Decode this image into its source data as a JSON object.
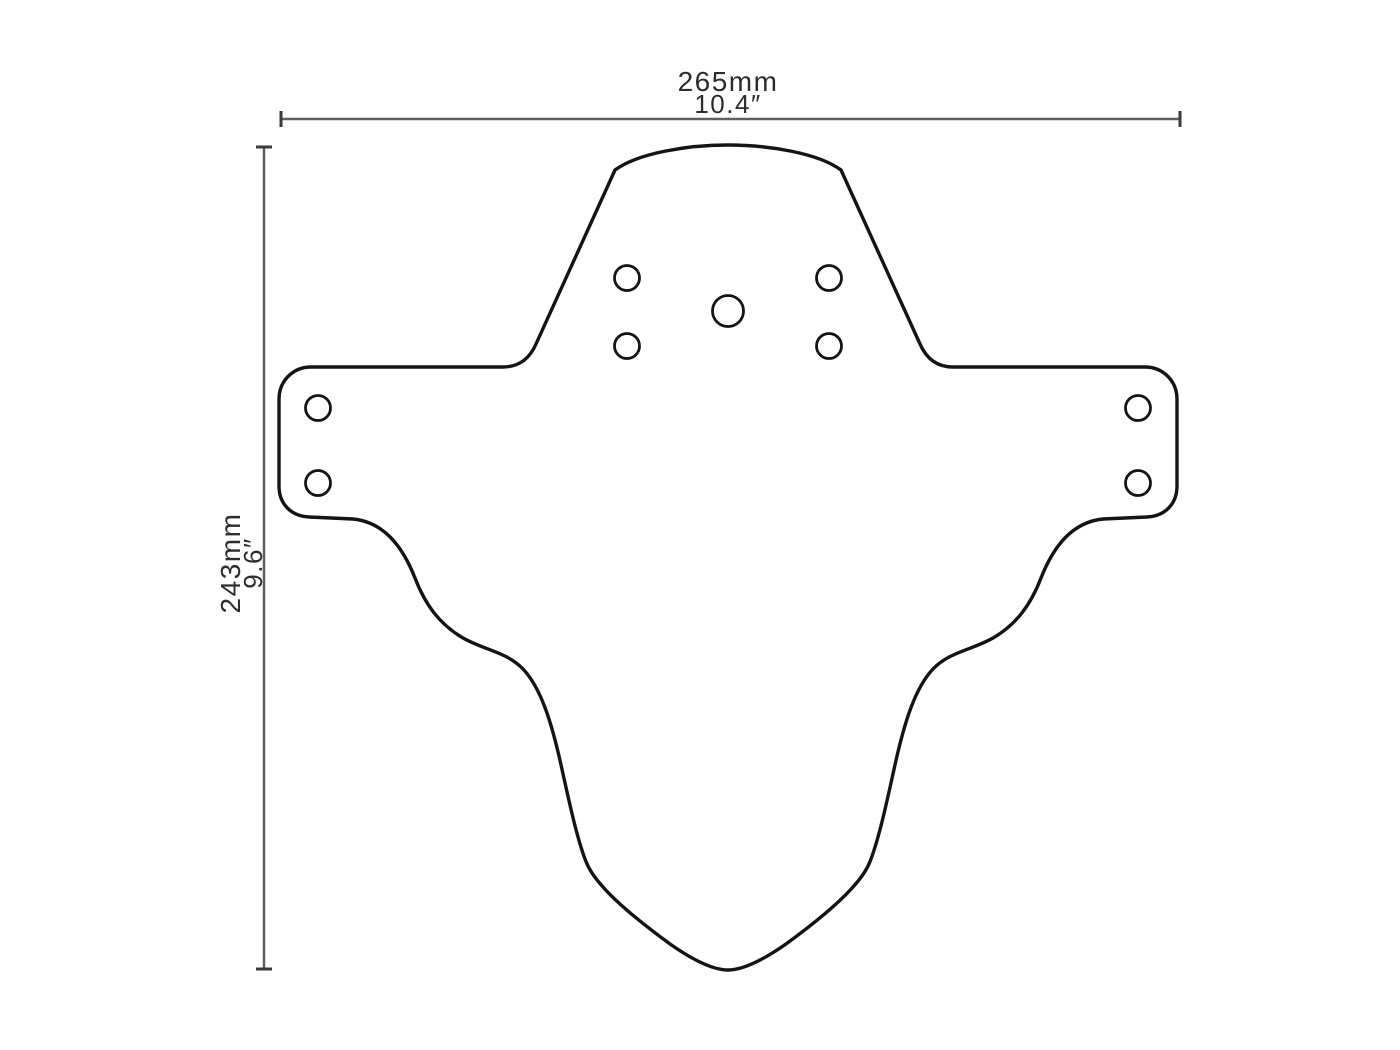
{
  "dimensions": {
    "width": {
      "mm": "265mm",
      "inches": "10.4″"
    },
    "height": {
      "mm": "243mm",
      "inches": "9.6″"
    }
  },
  "colors": {
    "background": "#ffffff",
    "outline": "#141414",
    "hole_stroke": "#141414",
    "dimension_line": "#5f5f5f",
    "dimension_tick": "#3a3a3a",
    "label_text": "#2d2d2d"
  }
}
